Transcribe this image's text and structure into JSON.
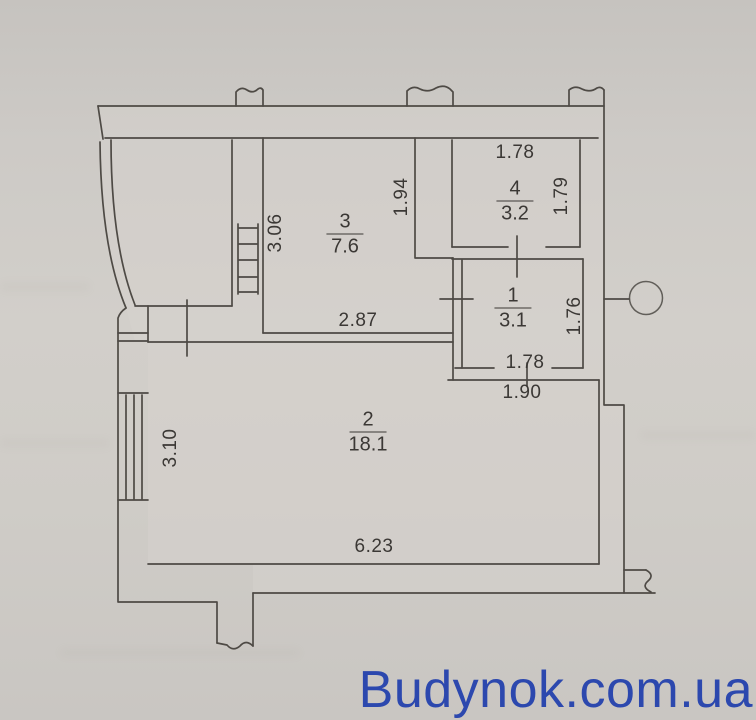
{
  "watermark": {
    "text": "Budynok.com.ua",
    "color": "#2c48ae"
  },
  "rooms": [
    {
      "number": "3",
      "area": "7.6",
      "x": 345,
      "y": 234
    },
    {
      "number": "4",
      "area": "3.2",
      "x": 515,
      "y": 201
    },
    {
      "number": "1",
      "area": "3.1",
      "x": 513,
      "y": 308
    },
    {
      "number": "2",
      "area": "18.1",
      "x": 368,
      "y": 432
    }
  ],
  "dimensions": [
    {
      "label": "1.78",
      "x": 515,
      "y": 153,
      "orientation": "horizontal"
    },
    {
      "label": "1.79",
      "x": 562,
      "y": 196,
      "orientation": "vertical"
    },
    {
      "label": "1.94",
      "x": 402,
      "y": 197,
      "orientation": "vertical"
    },
    {
      "label": "3.06",
      "x": 276,
      "y": 233,
      "orientation": "vertical"
    },
    {
      "label": "2.87",
      "x": 358,
      "y": 321,
      "orientation": "horizontal"
    },
    {
      "label": "1.76",
      "x": 575,
      "y": 316,
      "orientation": "vertical"
    },
    {
      "label": "1.78",
      "x": 525,
      "y": 363,
      "orientation": "horizontal"
    },
    {
      "label": "1.90",
      "x": 522,
      "y": 393,
      "orientation": "horizontal"
    },
    {
      "label": "3.10",
      "x": 171,
      "y": 448,
      "orientation": "vertical"
    },
    {
      "label": "6.23",
      "x": 374,
      "y": 547,
      "orientation": "horizontal"
    }
  ],
  "colors": {
    "paper": "#cdcac6",
    "wall_line": "#4e4a45",
    "text": "#3b3835"
  }
}
